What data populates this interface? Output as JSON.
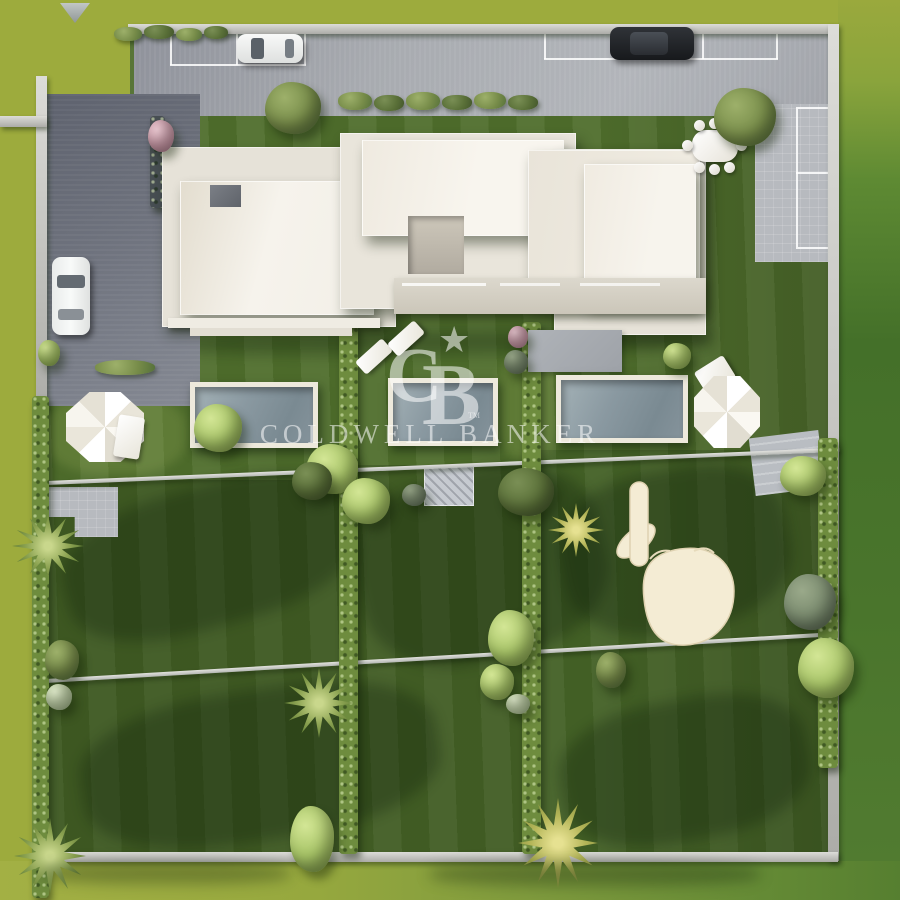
{
  "watermark": {
    "logo_c": "C",
    "logo_b": "B",
    "star": "★",
    "trademark": "TM",
    "brand": "COLDWELL BANKER"
  },
  "scene": {
    "type": "aerial-3d-architectural-render",
    "subject": "top-down view of a modern white villa complex with three garden plots, three pools, parking court and lawns",
    "cursor_icon": "pointing-hand",
    "marker_icon": "triangle-marker"
  },
  "palette": {
    "grass_outside": "#9DAB3D",
    "grass_inside": "#4F6E2C",
    "grass_dark": "#3A5523",
    "driveway": "#A6A9AE",
    "driveway_dark": "#70747F",
    "wall": "#C2C3BF",
    "hedge": "#6E8C3E",
    "roof": "#F3F0E8",
    "pool_water": "#8495A0",
    "pool_frame": "#EDE9DC",
    "hand": "#F4ECD4",
    "watermark_white": "rgba(255,255,255,0.55)"
  }
}
